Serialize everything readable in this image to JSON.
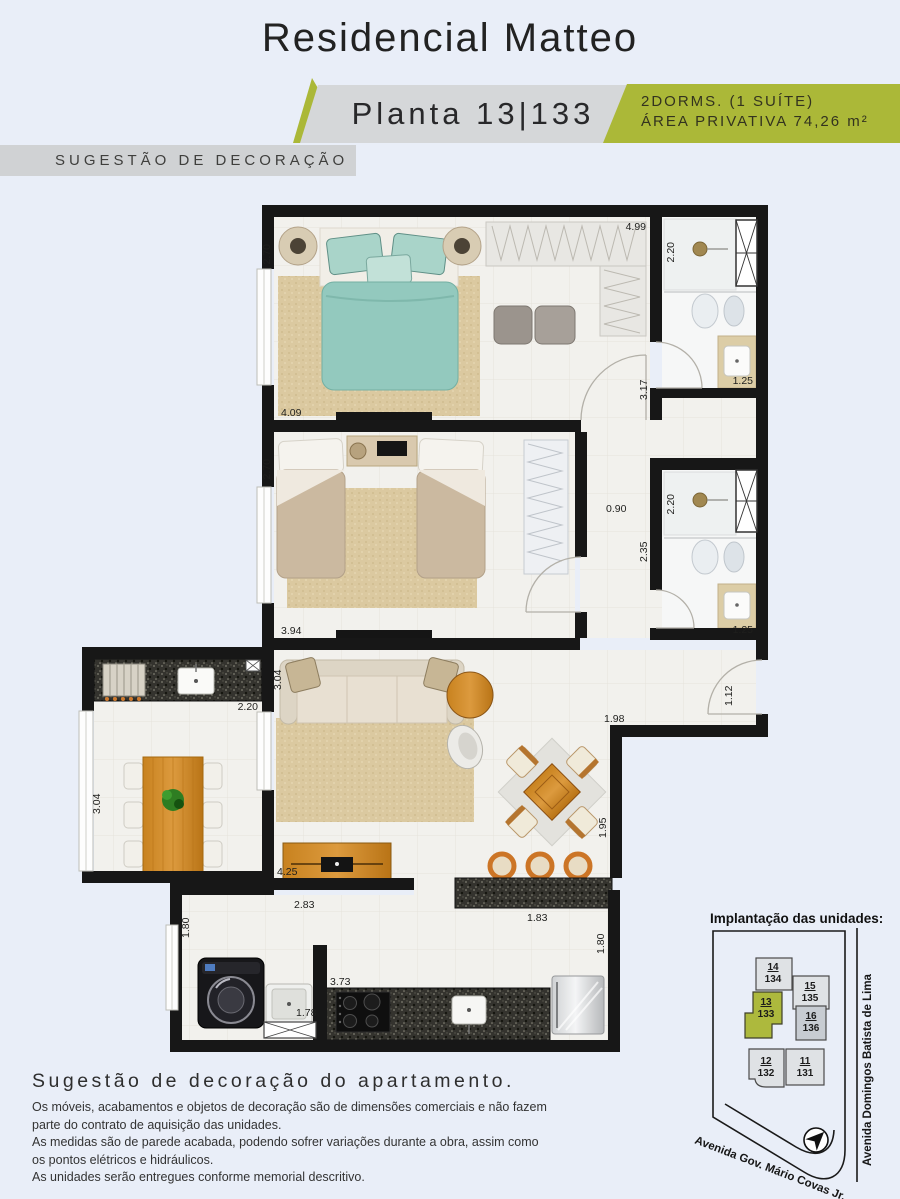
{
  "header": {
    "title": "Residencial Matteo",
    "plan_label": "Planta 13|133",
    "specs_line1": "2DORMS. (1 SUÍTE)",
    "specs_line2": "ÁREA PRIVATIVA 74,26 m²",
    "banner": "SUGESTÃO DE DECORAÇÃO"
  },
  "colors": {
    "accent_green": "#abb838",
    "band_gray": "#d5d7d9",
    "banner_gray": "#d0d2d4",
    "wall_black": "#171717",
    "background": "#e9eef8",
    "floor": "#f2f1ed"
  },
  "plan": {
    "measurements": [
      {
        "id": "suite-width",
        "value": "2.70"
      },
      {
        "id": "suite-closet-top",
        "value": "4.99"
      },
      {
        "id": "suite-bath-width",
        "value": "2.20"
      },
      {
        "id": "suite-right",
        "value": "3.17"
      },
      {
        "id": "suite-bath-sink",
        "value": "1.25"
      },
      {
        "id": "suite-length",
        "value": "4.09"
      },
      {
        "id": "bedroom2-width",
        "value": "2.70"
      },
      {
        "id": "hall-width",
        "value": "0.90"
      },
      {
        "id": "bath2-width",
        "value": "2.20"
      },
      {
        "id": "bath2-left",
        "value": "2.35"
      },
      {
        "id": "bath2-sink",
        "value": "1.25"
      },
      {
        "id": "bedroom2-length",
        "value": "3.94"
      },
      {
        "id": "living-left",
        "value": "3.04"
      },
      {
        "id": "balcony-counter",
        "value": "2.20"
      },
      {
        "id": "balcony-left",
        "value": "3.04"
      },
      {
        "id": "entry-wall",
        "value": "1.12"
      },
      {
        "id": "living-right-top",
        "value": "1.98"
      },
      {
        "id": "dining-right",
        "value": "1.95"
      },
      {
        "id": "living-length",
        "value": "4.25"
      },
      {
        "id": "laundry-top",
        "value": "2.83"
      },
      {
        "id": "laundry-left",
        "value": "1.80"
      },
      {
        "id": "bar-counter",
        "value": "1.83"
      },
      {
        "id": "kitchen-right",
        "value": "1.80"
      },
      {
        "id": "laundry-tank",
        "value": "1.78"
      },
      {
        "id": "kitchen-counter",
        "value": "3.73"
      }
    ]
  },
  "site_plan": {
    "title": "Implantação das unidades:",
    "units": [
      {
        "unit": "14",
        "apartment": "134",
        "highlighted": false
      },
      {
        "unit": "15",
        "apartment": "135",
        "highlighted": false
      },
      {
        "unit": "13",
        "apartment": "133",
        "highlighted": true
      },
      {
        "unit": "16",
        "apartment": "136",
        "highlighted": false
      },
      {
        "unit": "12",
        "apartment": "132",
        "highlighted": false
      },
      {
        "unit": "11",
        "apartment": "131",
        "highlighted": false
      }
    ],
    "streets": {
      "right": "Avenida Domingos Batista de Lima",
      "bottom": "Avenida Gov. Mário Covas Jr."
    }
  },
  "footer": {
    "heading": "Sugestão de decoração do apartamento.",
    "lines": [
      "Os móveis, acabamentos e objetos de decoração são de dimensões comerciais e não fazem",
      "parte do contrato de aquisição das unidades.",
      "As medidas são de parede acabada, podendo sofrer variações durante a obra, assim como",
      "os pontos elétricos e hidráulicos.",
      "As unidades serão entregues conforme memorial descritivo."
    ]
  }
}
